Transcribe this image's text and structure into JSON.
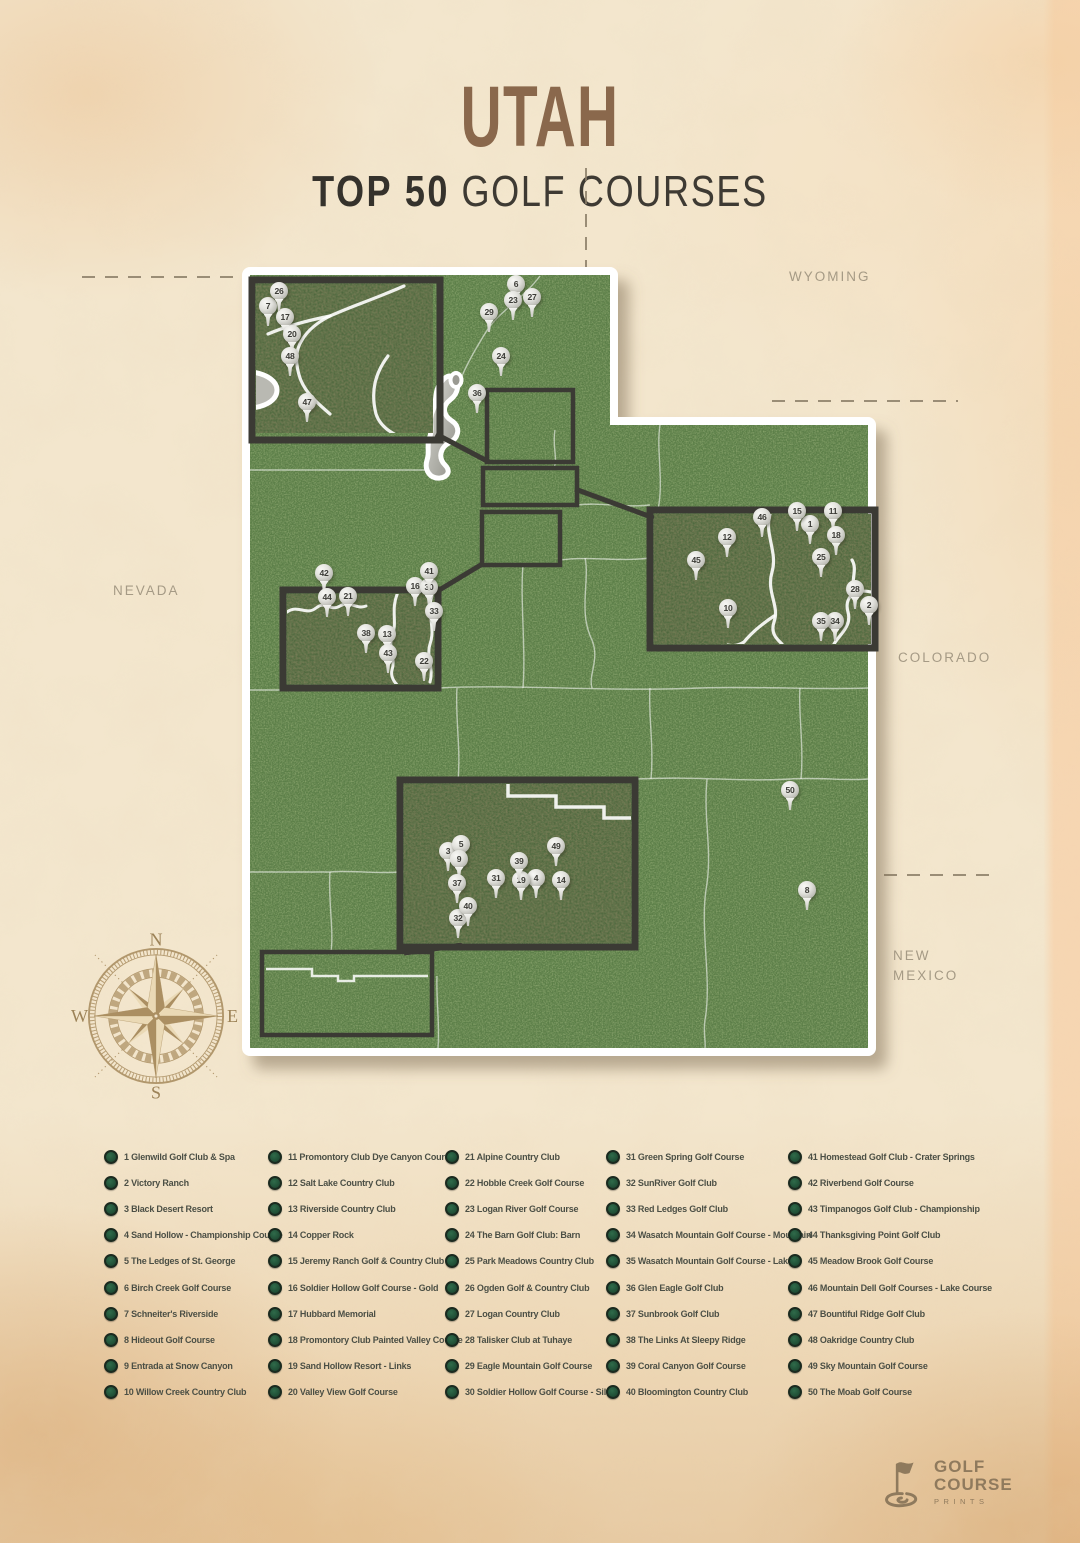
{
  "header": {
    "title": "UTAH",
    "subtitle_bold": "TOP 50",
    "subtitle_rest": "GOLF COURSES"
  },
  "states": {
    "wyoming": "WYOMING",
    "nevada": "NEVADA",
    "colorado": "COLORADO",
    "new_mexico_1": "NEW",
    "new_mexico_2": "MEXICO"
  },
  "compass": {
    "n": "N",
    "e": "E",
    "s": "S",
    "w": "W"
  },
  "colors": {
    "paper": "#f3e6cd",
    "map_green": "#5b7f47",
    "inset_green": "#4d653c",
    "frame_dark": "#3b3a34",
    "accent_brown": "#8a684c",
    "ink": "#3e3a33",
    "legend_bullet_green": "#26573d",
    "muted_label": "#a59a85"
  },
  "map": {
    "pins": [
      {
        "n": 1,
        "x": 810,
        "y": 524
      },
      {
        "n": 2,
        "x": 869,
        "y": 605
      },
      {
        "n": 3,
        "x": 448,
        "y": 851
      },
      {
        "n": 4,
        "x": 536,
        "y": 878
      },
      {
        "n": 5,
        "x": 461,
        "y": 844
      },
      {
        "n": 6,
        "x": 516,
        "y": 284
      },
      {
        "n": 7,
        "x": 268,
        "y": 306
      },
      {
        "n": 8,
        "x": 807,
        "y": 890
      },
      {
        "n": 9,
        "x": 459,
        "y": 859
      },
      {
        "n": 10,
        "x": 728,
        "y": 608
      },
      {
        "n": 11,
        "x": 833,
        "y": 511
      },
      {
        "n": 12,
        "x": 727,
        "y": 537
      },
      {
        "n": 13,
        "x": 387,
        "y": 634
      },
      {
        "n": 14,
        "x": 561,
        "y": 880
      },
      {
        "n": 15,
        "x": 797,
        "y": 511
      },
      {
        "n": 16,
        "x": 415,
        "y": 586
      },
      {
        "n": 17,
        "x": 285,
        "y": 317
      },
      {
        "n": 18,
        "x": 836,
        "y": 535
      },
      {
        "n": 19,
        "x": 521,
        "y": 880
      },
      {
        "n": 20,
        "x": 292,
        "y": 334
      },
      {
        "n": 21,
        "x": 348,
        "y": 596
      },
      {
        "n": 22,
        "x": 424,
        "y": 661
      },
      {
        "n": 23,
        "x": 513,
        "y": 300
      },
      {
        "n": 24,
        "x": 501,
        "y": 356
      },
      {
        "n": 25,
        "x": 821,
        "y": 557
      },
      {
        "n": 26,
        "x": 279,
        "y": 291
      },
      {
        "n": 27,
        "x": 532,
        "y": 297
      },
      {
        "n": 28,
        "x": 855,
        "y": 589
      },
      {
        "n": 29,
        "x": 489,
        "y": 312
      },
      {
        "n": 30,
        "x": 429,
        "y": 587
      },
      {
        "n": 31,
        "x": 496,
        "y": 878
      },
      {
        "n": 32,
        "x": 458,
        "y": 918
      },
      {
        "n": 33,
        "x": 434,
        "y": 611
      },
      {
        "n": 34,
        "x": 835,
        "y": 621
      },
      {
        "n": 35,
        "x": 821,
        "y": 621
      },
      {
        "n": 36,
        "x": 477,
        "y": 393
      },
      {
        "n": 37,
        "x": 457,
        "y": 883
      },
      {
        "n": 38,
        "x": 366,
        "y": 633
      },
      {
        "n": 39,
        "x": 519,
        "y": 861
      },
      {
        "n": 40,
        "x": 468,
        "y": 906
      },
      {
        "n": 41,
        "x": 429,
        "y": 571
      },
      {
        "n": 42,
        "x": 324,
        "y": 573
      },
      {
        "n": 43,
        "x": 388,
        "y": 653
      },
      {
        "n": 44,
        "x": 327,
        "y": 597
      },
      {
        "n": 45,
        "x": 696,
        "y": 560
      },
      {
        "n": 46,
        "x": 762,
        "y": 517
      },
      {
        "n": 47,
        "x": 307,
        "y": 402
      },
      {
        "n": 48,
        "x": 290,
        "y": 356
      },
      {
        "n": 49,
        "x": 556,
        "y": 846
      },
      {
        "n": 50,
        "x": 790,
        "y": 790
      }
    ]
  },
  "legend": {
    "items": [
      {
        "n": 1,
        "label": "Glenwild Golf Club & Spa"
      },
      {
        "n": 2,
        "label": "Victory Ranch"
      },
      {
        "n": 3,
        "label": "Black Desert Resort"
      },
      {
        "n": 4,
        "label": "Sand Hollow - Championship Course"
      },
      {
        "n": 5,
        "label": "The Ledges of St. George"
      },
      {
        "n": 6,
        "label": "Birch Creek Golf Course"
      },
      {
        "n": 7,
        "label": "Schneiter's Riverside"
      },
      {
        "n": 8,
        "label": "Hideout Golf Course"
      },
      {
        "n": 9,
        "label": "Entrada at Snow Canyon"
      },
      {
        "n": 10,
        "label": "Willow Creek Country Club"
      },
      {
        "n": 11,
        "label": "Promontory Club Dye Canyon Course"
      },
      {
        "n": 12,
        "label": "Salt Lake Country Club"
      },
      {
        "n": 13,
        "label": "Riverside Country Club"
      },
      {
        "n": 14,
        "label": "Copper Rock"
      },
      {
        "n": 15,
        "label": "Jeremy Ranch Golf & Country Club"
      },
      {
        "n": 16,
        "label": "Soldier Hollow Golf Course - Gold"
      },
      {
        "n": 17,
        "label": "Hubbard Memorial"
      },
      {
        "n": 18,
        "label": "Promontory Club Painted Valley Course"
      },
      {
        "n": 19,
        "label": "Sand Hollow Resort - Links"
      },
      {
        "n": 20,
        "label": "Valley View Golf Course"
      },
      {
        "n": 21,
        "label": "Alpine Country Club"
      },
      {
        "n": 22,
        "label": "Hobble Creek Golf Course"
      },
      {
        "n": 23,
        "label": "Logan River Golf Course"
      },
      {
        "n": 24,
        "label": "The Barn Golf Club: Barn"
      },
      {
        "n": 25,
        "label": "Park Meadows Country Club"
      },
      {
        "n": 26,
        "label": "Ogden Golf & Country Club"
      },
      {
        "n": 27,
        "label": "Logan Country Club"
      },
      {
        "n": 28,
        "label": "Talisker Club at Tuhaye"
      },
      {
        "n": 29,
        "label": "Eagle Mountain Golf Course"
      },
      {
        "n": 30,
        "label": "Soldier Hollow Golf Course - Silver"
      },
      {
        "n": 31,
        "label": "Green Spring Golf Course"
      },
      {
        "n": 32,
        "label": "SunRiver Golf Club"
      },
      {
        "n": 33,
        "label": "Red Ledges Golf Club"
      },
      {
        "n": 34,
        "label": "Wasatch Mountain Golf Course - Mountain"
      },
      {
        "n": 35,
        "label": "Wasatch Mountain Golf Course - Lake"
      },
      {
        "n": 36,
        "label": "Glen Eagle Golf Club"
      },
      {
        "n": 37,
        "label": "Sunbrook Golf Club"
      },
      {
        "n": 38,
        "label": "The Links At Sleepy Ridge"
      },
      {
        "n": 39,
        "label": "Coral Canyon Golf Course"
      },
      {
        "n": 40,
        "label": "Bloomington Country Club"
      },
      {
        "n": 41,
        "label": "Homestead Golf Club - Crater Springs"
      },
      {
        "n": 42,
        "label": "Riverbend Golf Course"
      },
      {
        "n": 43,
        "label": "Timpanogos Golf Club - Championship"
      },
      {
        "n": 44,
        "label": "Thanksgiving Point Golf Club"
      },
      {
        "n": 45,
        "label": "Meadow Brook Golf Course"
      },
      {
        "n": 46,
        "label": "Mountain Dell Golf Courses - Lake Course"
      },
      {
        "n": 47,
        "label": "Bountiful Ridge Golf Club"
      },
      {
        "n": 48,
        "label": "Oakridge Country Club"
      },
      {
        "n": 49,
        "label": "Sky Mountain Golf Course"
      },
      {
        "n": 50,
        "label": "The Moab Golf Course"
      }
    ]
  },
  "logo": {
    "line1": "GOLF",
    "line2": "COURSE",
    "line3": "PRINTS"
  }
}
